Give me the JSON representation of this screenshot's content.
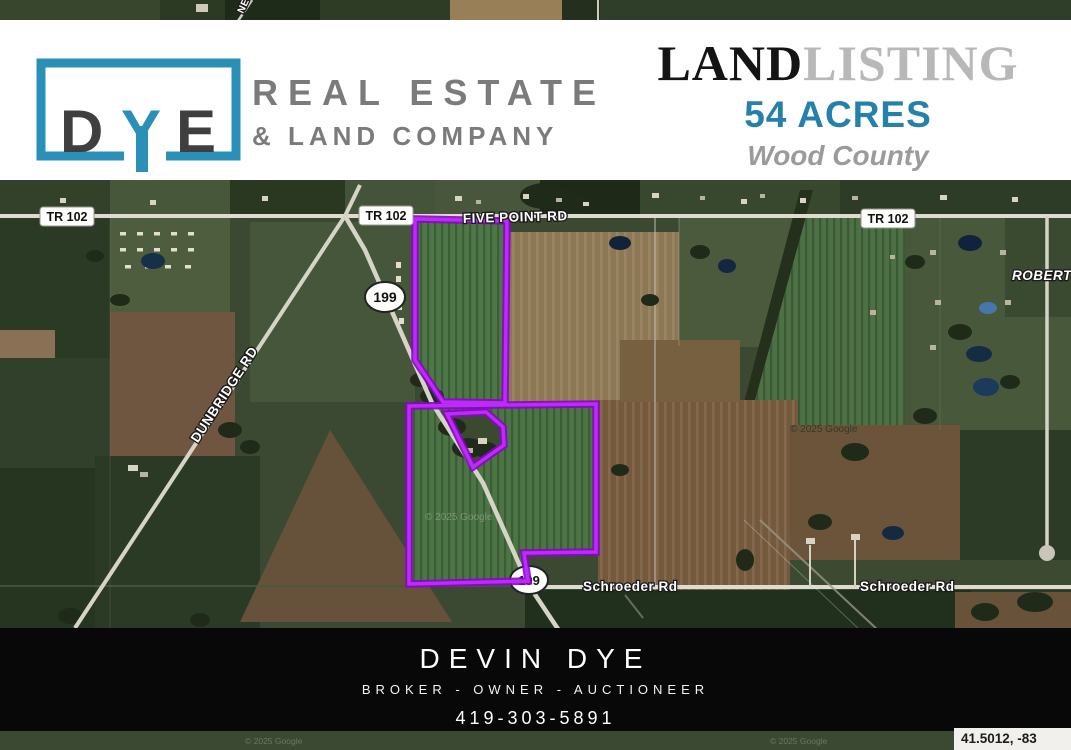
{
  "header": {
    "logo": {
      "letter_d": "D",
      "letter_y": "Y",
      "letter_e": "E",
      "line1": "REAL ESTATE",
      "line2": "& LAND COMPANY",
      "accent_color": "#2a90b8"
    },
    "listing": {
      "word_land": "LAND",
      "word_listing": "LISTING",
      "acres": "54 ACRES",
      "county": "Wood County",
      "acres_color": "#2581ab"
    }
  },
  "map": {
    "road_labels": {
      "tr102": "TR 102",
      "five_point": "FIVE POINT RD",
      "dunbridge": "DUNBRIDGE RD",
      "schroeder": "Schroeder Rd",
      "roberts": "ROBERTS",
      "route199": "199",
      "top_fragment": "NEO"
    },
    "watermark": "© 2025 Google",
    "coordinates": "41.5012, -83",
    "parcel_outline_color": "#b116f2"
  },
  "footer": {
    "name": "DEVIN DYE",
    "title": "BROKER - OWNER - AUCTIONEER",
    "phone": "419-303-5891"
  }
}
